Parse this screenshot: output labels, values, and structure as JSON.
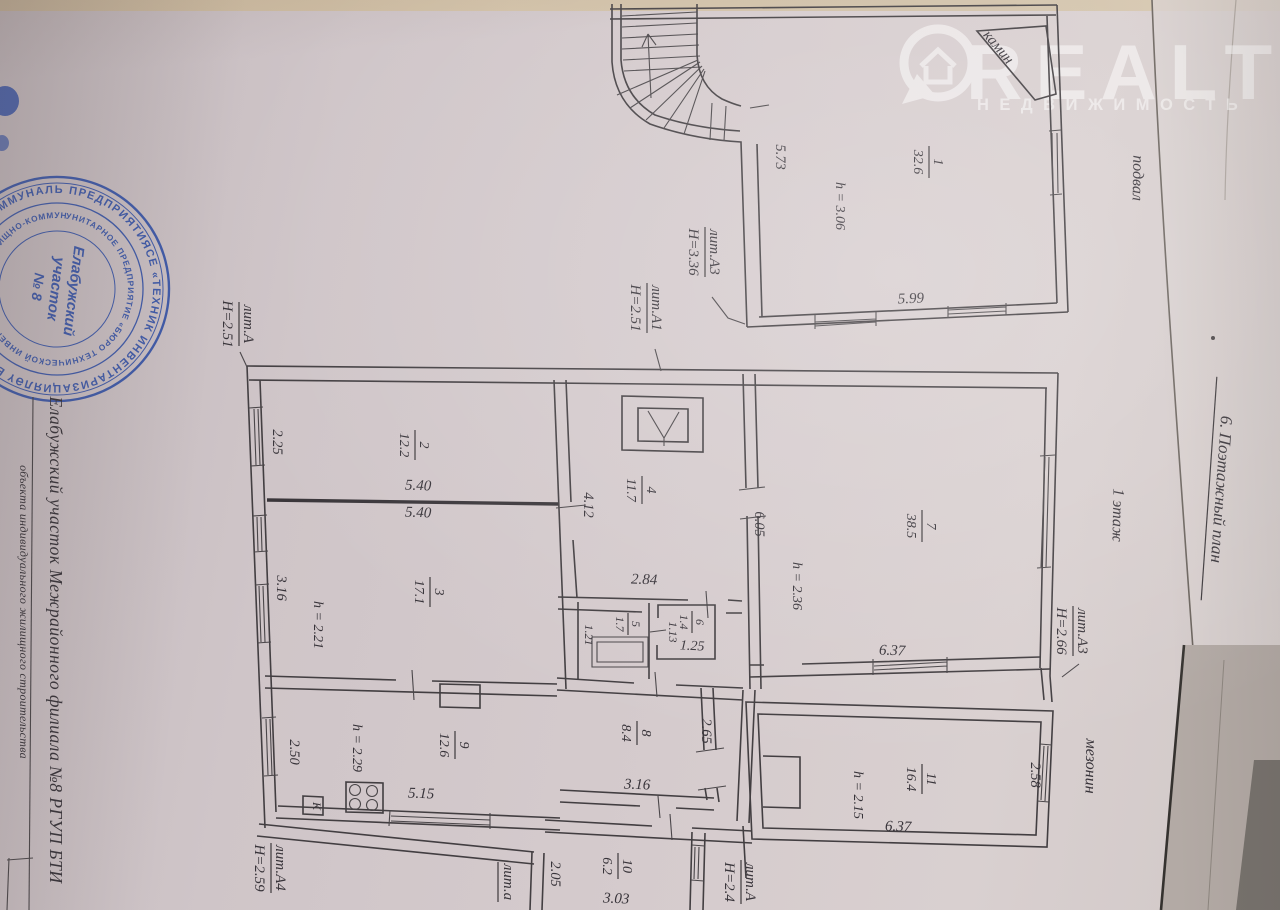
{
  "texts": {
    "header": "6. Поэтажный план",
    "margin_caption": "Елабужский участок Межрайонного филиала №8 РГУП БТИ",
    "margin_caption_small": "объекта индивидуального жилищного строительства",
    "basement_label": "подвал",
    "first_floor_label": "1 этаж",
    "mezzanine_label": "мезонин",
    "fireplace_label": "камин",
    "kitchen_marker": "К"
  },
  "watermark": {
    "brand": "REALT",
    "tagline": "НЕДВИЖИМОСТЬ",
    "icon": "house-pin-icon"
  },
  "stamp": {
    "ring_outer": "ПРЕДПРИЯТИЯСЕ «ТЕХНИК ИНВЕНТАРИЗАЦИЯЛӘҮ БЮРОСЫ» • ЭШМ ТОРАК-КОММУНАЛЬ ХУҖАЛЫГЫ •",
    "ring_inner": "УНИТАРНОЕ ПРЕДПРИЯТИЕ «БЮРО ТЕХНИЧЕСКОЙ ИНВЕНТАРИЗАЦИИ» ЖИЛИЩНО-КОММУНАЛЬНОГО ХОЗЯЙСТВА",
    "center_line1": "Елабужский",
    "center_line2": "участок",
    "center_line3": "№ 8"
  },
  "litera": {
    "basement_a3": {
      "name": "лит.А3",
      "height": "Н=3.36"
    },
    "basement_a1": {
      "name": "лит.А1",
      "height": "Н=2.51"
    },
    "first_a": {
      "name": "лит.А",
      "height": "Н=2.51"
    },
    "first_a3": {
      "name": "лит.А3",
      "height": "Н=2.66"
    },
    "first_a4": {
      "name": "лит.А4",
      "height": "Н=2.59"
    },
    "mezz_a": {
      "name": "лит.А",
      "height": "Н=2.4"
    },
    "veranda_a": {
      "name": "лит.а"
    }
  },
  "rooms": {
    "r1": {
      "num": "1",
      "area": "32.6",
      "height": "h = 3.06"
    },
    "r2": {
      "num": "2",
      "area": "12.2"
    },
    "r3": {
      "num": "3",
      "area": "17.1",
      "height": "h = 2.21"
    },
    "r4": {
      "num": "4",
      "area": "11.7"
    },
    "r5": {
      "num": "5",
      "area": "1.7"
    },
    "r6": {
      "num": "6",
      "area": "1.4"
    },
    "r7": {
      "num": "7",
      "area": "38.5",
      "height": "h = 2.36"
    },
    "r8": {
      "num": "8",
      "area": "8.4"
    },
    "r9": {
      "num": "9",
      "area": "12.6",
      "height": "h = 2.29"
    },
    "r10": {
      "num": "10",
      "area": "6.2"
    },
    "r11": {
      "num": "11",
      "area": "16.4",
      "height": "h = 2.15"
    }
  },
  "dims": {
    "basement_left": "5.73",
    "basement_bottom": "5.99",
    "ff_top_left": "2.25",
    "ff_mid_upper": "5.40",
    "ff_mid_lower": "5.40",
    "r3_left": "3.16",
    "r4_left": "4.12",
    "r4_bottom": "2.84",
    "r5_left": "1.21",
    "r6_left": "1.13",
    "r6_bottom": "1.25",
    "r7_left": "6.05",
    "r7_bottom": "6.37",
    "r8_right": "2.65",
    "r8_bottom": "3.16",
    "r9_left": "2.50",
    "r9_bottom": "5.15",
    "r10_left": "2.05",
    "r10_bottom": "3.03",
    "r11_right": "2.58",
    "r11_bottom": "6.37"
  }
}
